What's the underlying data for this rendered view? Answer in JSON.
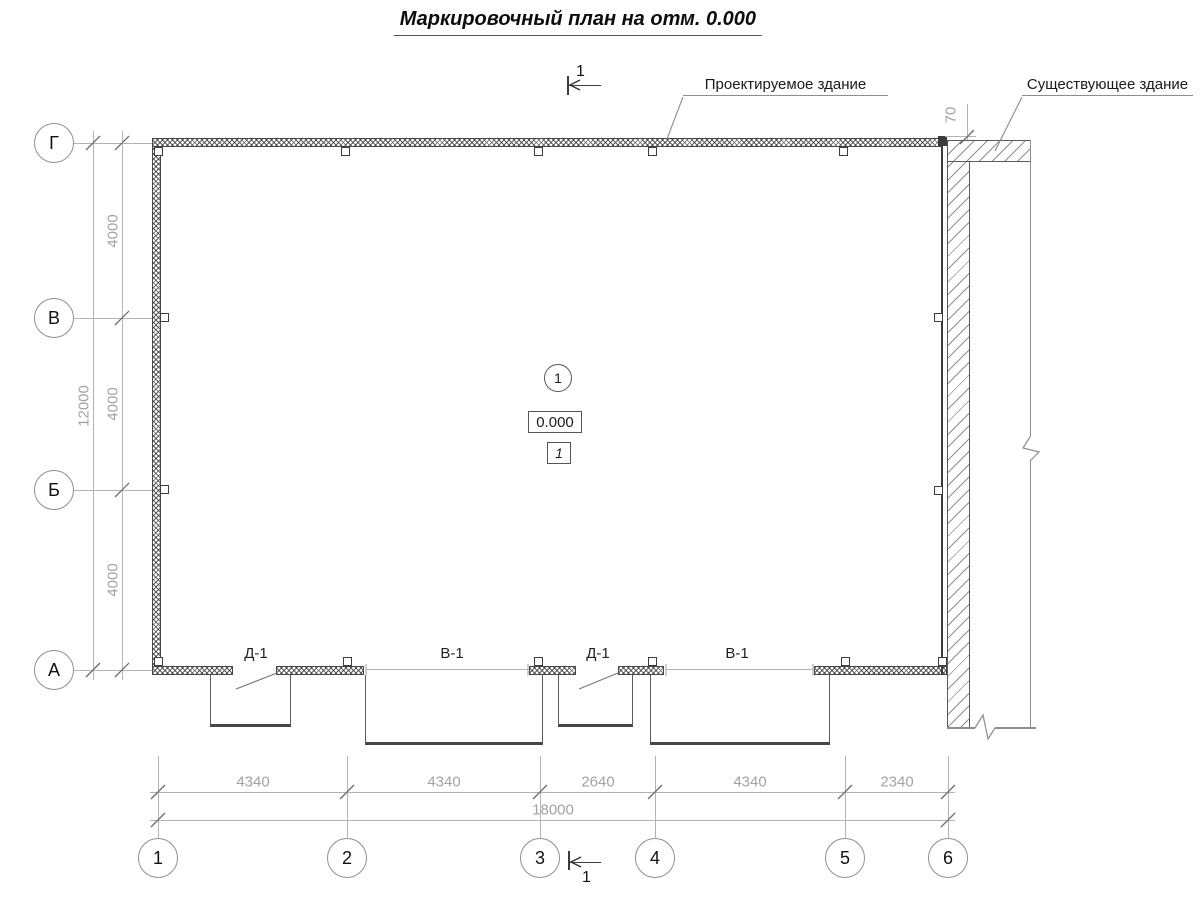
{
  "title": "Маркировочный план на отм. 0.000",
  "callouts": {
    "projected": "Проектируемое здание",
    "existing": "Существующее здание"
  },
  "section_label": "1",
  "markers": {
    "node": "1",
    "level": "0.000",
    "room": "1"
  },
  "openings": [
    "Д-1",
    "В-1",
    "Д-1",
    "В-1"
  ],
  "axes": {
    "vertical": [
      "Г",
      "В",
      "Б",
      "А"
    ],
    "horizontal": [
      "1",
      "2",
      "3",
      "4",
      "5",
      "6"
    ]
  },
  "dimensions": {
    "left_segments": [
      "4000",
      "4000",
      "4000"
    ],
    "left_total": "12000",
    "bottom_segments": [
      "4340",
      "4340",
      "2640",
      "4340",
      "2340"
    ],
    "bottom_total": "18000",
    "building_gap": "70"
  },
  "colors": {
    "drawing_line": "#3c3c3c",
    "dimension_gray": "#a2a2a2",
    "hatch_gray": "#8f8f8f"
  }
}
